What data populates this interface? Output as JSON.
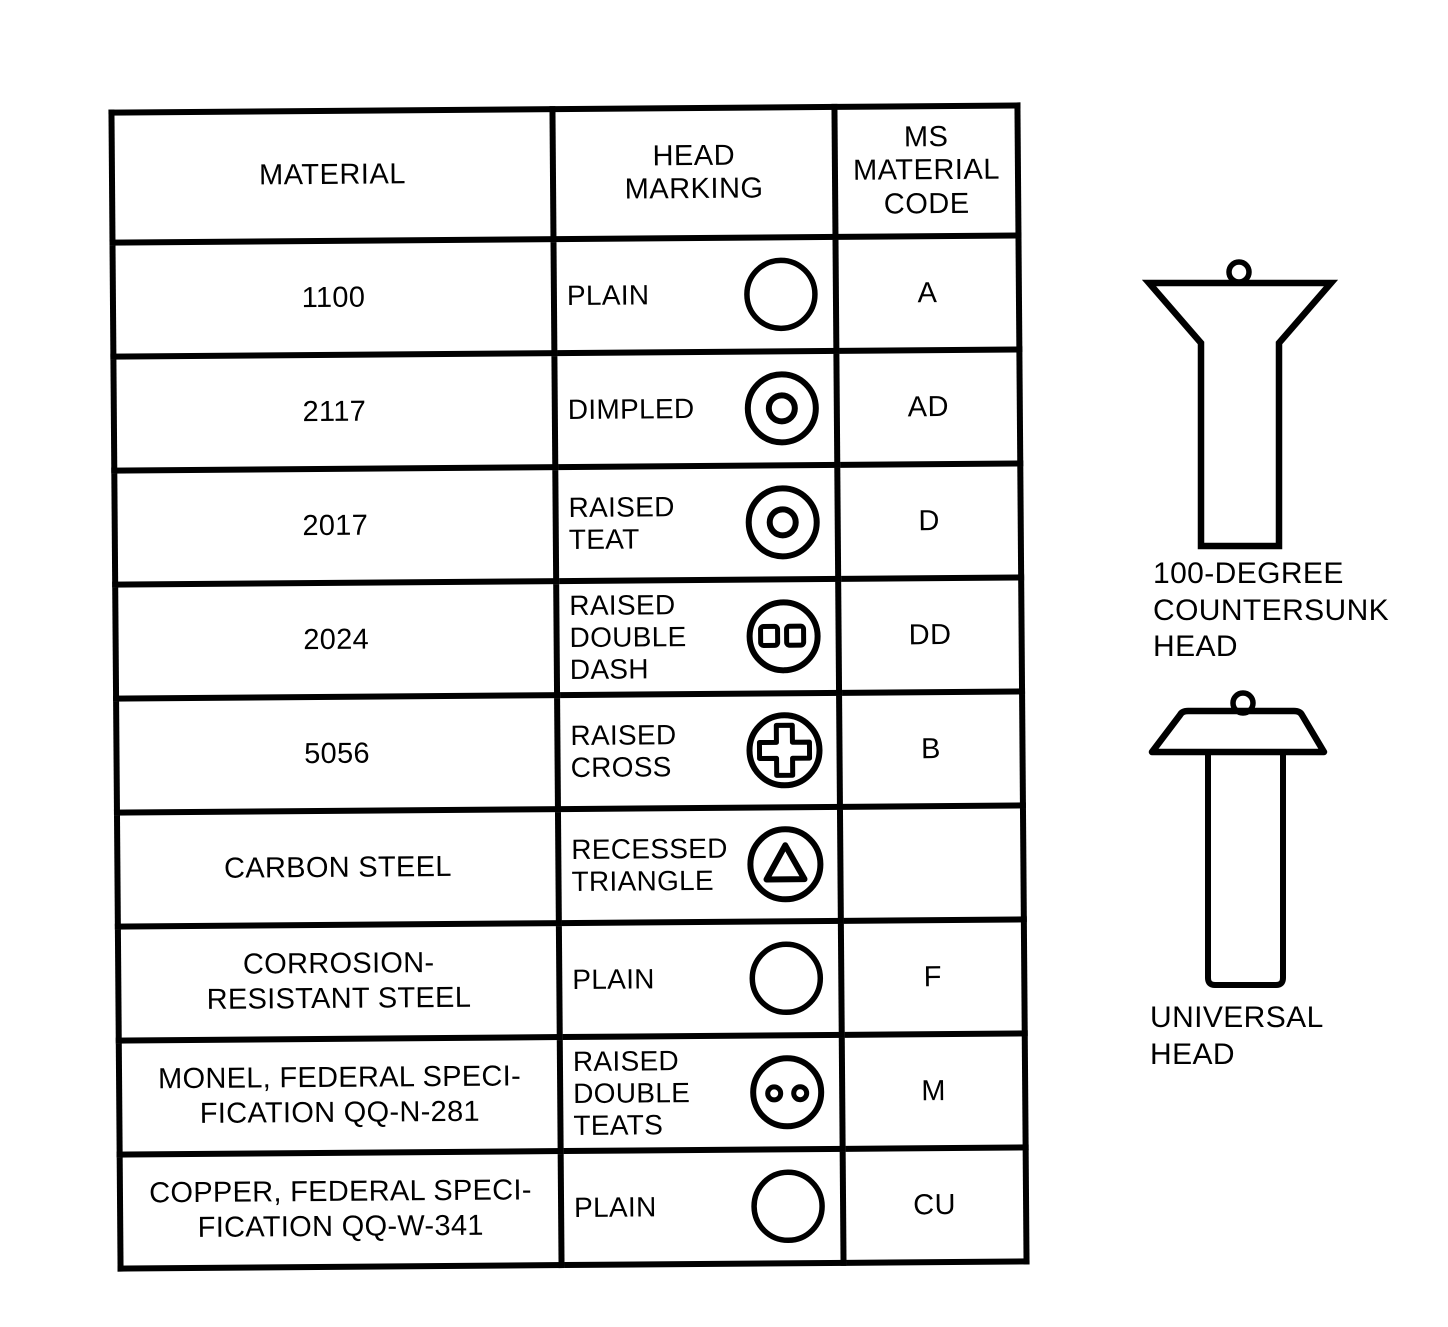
{
  "figure": {
    "description_colors": {
      "ink": "#000000",
      "paper": "#ffffff"
    }
  },
  "table": {
    "headers": [
      "MATERIAL",
      "HEAD\nMARKING",
      "MS\nMATERIAL\nCODE"
    ],
    "rows": [
      {
        "material": "1100",
        "marking": "PLAIN",
        "icon": "plain-circle-icon",
        "code": "A"
      },
      {
        "material": "2117",
        "marking": "DIMPLED",
        "icon": "dimpled-icon",
        "code": "AD"
      },
      {
        "material": "2017",
        "marking": "RAISED\nTEAT",
        "icon": "raised-teat-icon",
        "code": "D"
      },
      {
        "material": "2024",
        "marking": "RAISED\nDOUBLE\nDASH",
        "icon": "raised-double-dash-icon",
        "code": "DD"
      },
      {
        "material": "5056",
        "marking": "RAISED\nCROSS",
        "icon": "raised-cross-icon",
        "code": "B"
      },
      {
        "material": "CARBON STEEL",
        "marking": "RECESSED\nTRIANGLE",
        "icon": "recessed-triangle-icon",
        "code": ""
      },
      {
        "material": "CORROSION-\nRESISTANT STEEL",
        "marking": "PLAIN",
        "icon": "plain-circle-icon",
        "code": "F"
      },
      {
        "material": "MONEL, FEDERAL SPECI-\nFICATION QQ-N-281",
        "marking": "RAISED\nDOUBLE\nTEATS",
        "icon": "raised-double-teats-icon",
        "code": "M"
      },
      {
        "material": "COPPER, FEDERAL SPECI-\nFICATION QQ-W-341",
        "marking": "PLAIN",
        "icon": "plain-circle-icon",
        "code": "CU"
      }
    ]
  },
  "diagrams": [
    {
      "label": "100-DEGREE\nCOUNTERSUNK\nHEAD",
      "icon": "countersunk-rivet-diagram"
    },
    {
      "label": "UNIVERSAL\nHEAD",
      "icon": "universal-rivet-diagram"
    }
  ]
}
